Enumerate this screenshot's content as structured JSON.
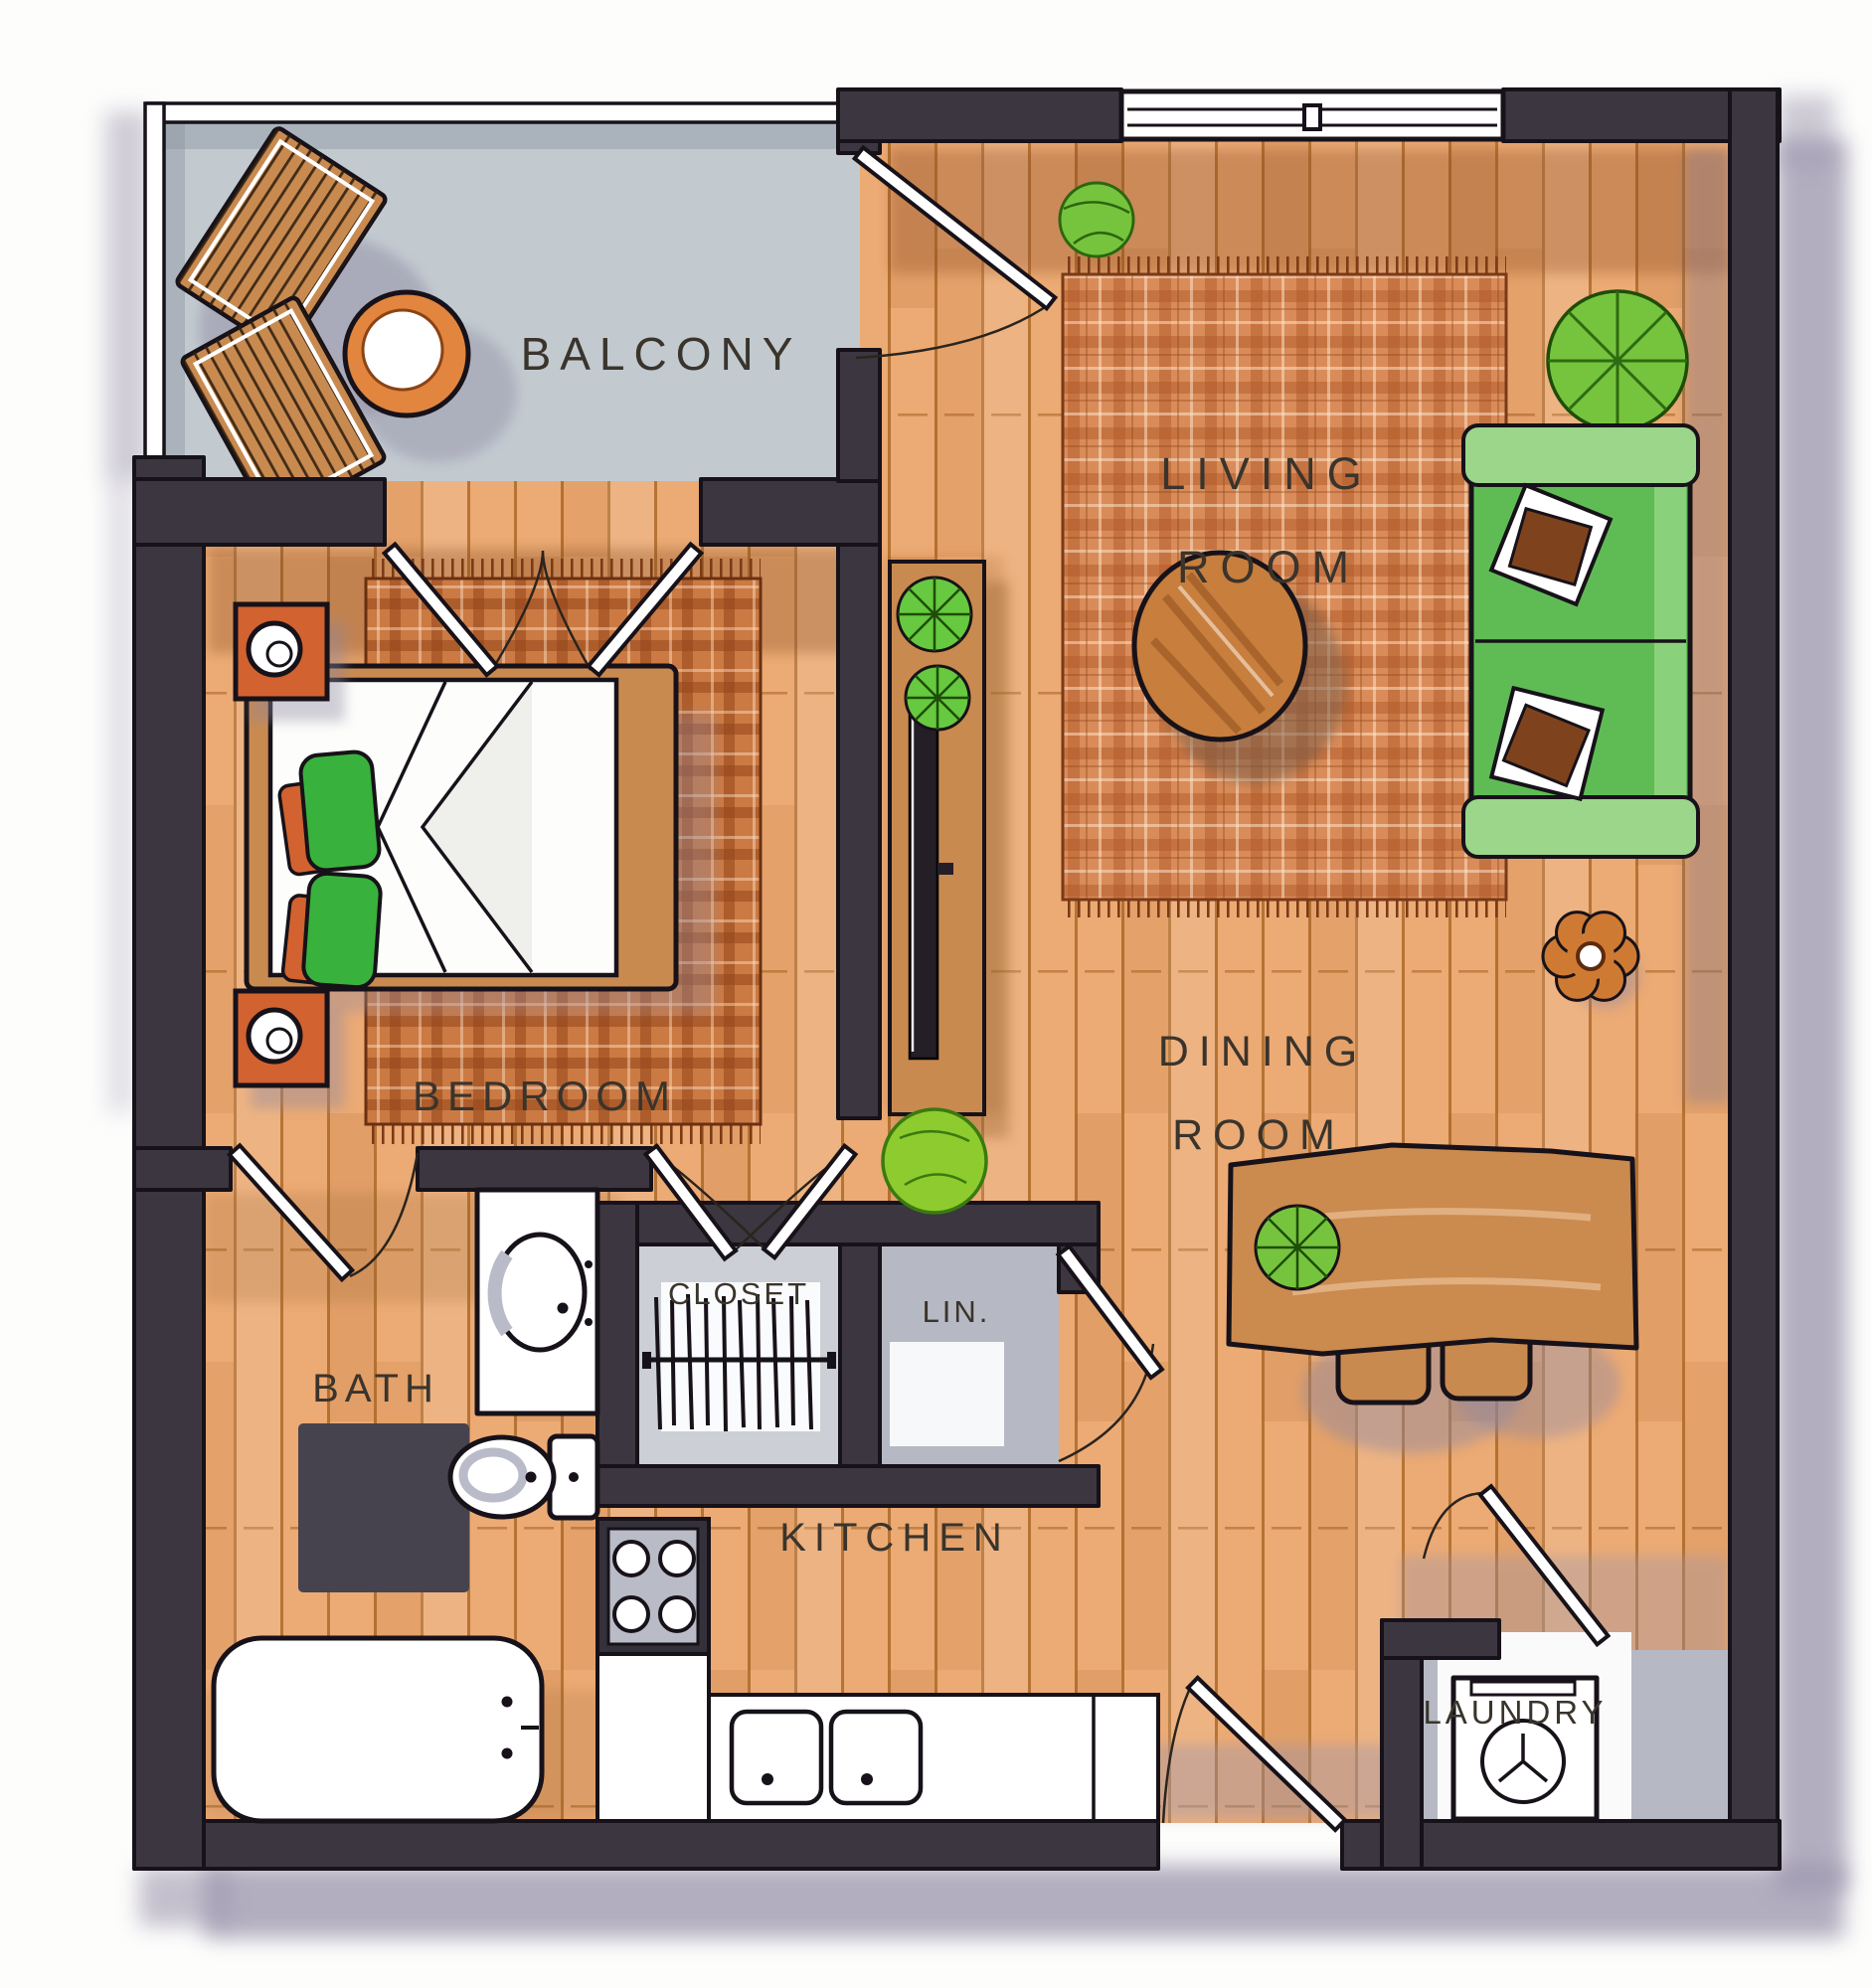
{
  "labels": {
    "balcony": "BALCONY",
    "living": [
      "LIVING",
      "ROOM"
    ],
    "bedroom": "BEDROOM",
    "dining": [
      "DINING",
      "ROOM"
    ],
    "bath": "BATH",
    "closet": "CLOSET",
    "linen": "LIN.",
    "kitchen": "KITCHEN",
    "laundry": "LAUNDRY"
  },
  "rooms": [
    {
      "id": "balcony",
      "label": "BALCONY"
    },
    {
      "id": "living-room",
      "label": "LIVING ROOM"
    },
    {
      "id": "bedroom",
      "label": "BEDROOM"
    },
    {
      "id": "dining-room",
      "label": "DINING ROOM"
    },
    {
      "id": "bath",
      "label": "BATH"
    },
    {
      "id": "closet",
      "label": "CLOSET"
    },
    {
      "id": "linen-closet",
      "label": "LIN."
    },
    {
      "id": "kitchen",
      "label": "KITCHEN"
    },
    {
      "id": "laundry",
      "label": "LAUNDRY"
    }
  ],
  "colors": {
    "wall": "#3b3640",
    "ink": "#171219",
    "text": "#3a342c",
    "wood": "#ecaa74",
    "wood_line": "#a4611f",
    "balcony_floor": "#c2cad0",
    "rug": "#d98c59",
    "rug_dark": "#cb7a43",
    "sofa": "#5fbc55",
    "sofa_arm": "#9bd68b",
    "plant": "#76c43e",
    "wood_furn": "#c98a50",
    "accent": "#d2622f",
    "shadow": "#9d97ae",
    "grey_int": "#b6b9c3"
  }
}
